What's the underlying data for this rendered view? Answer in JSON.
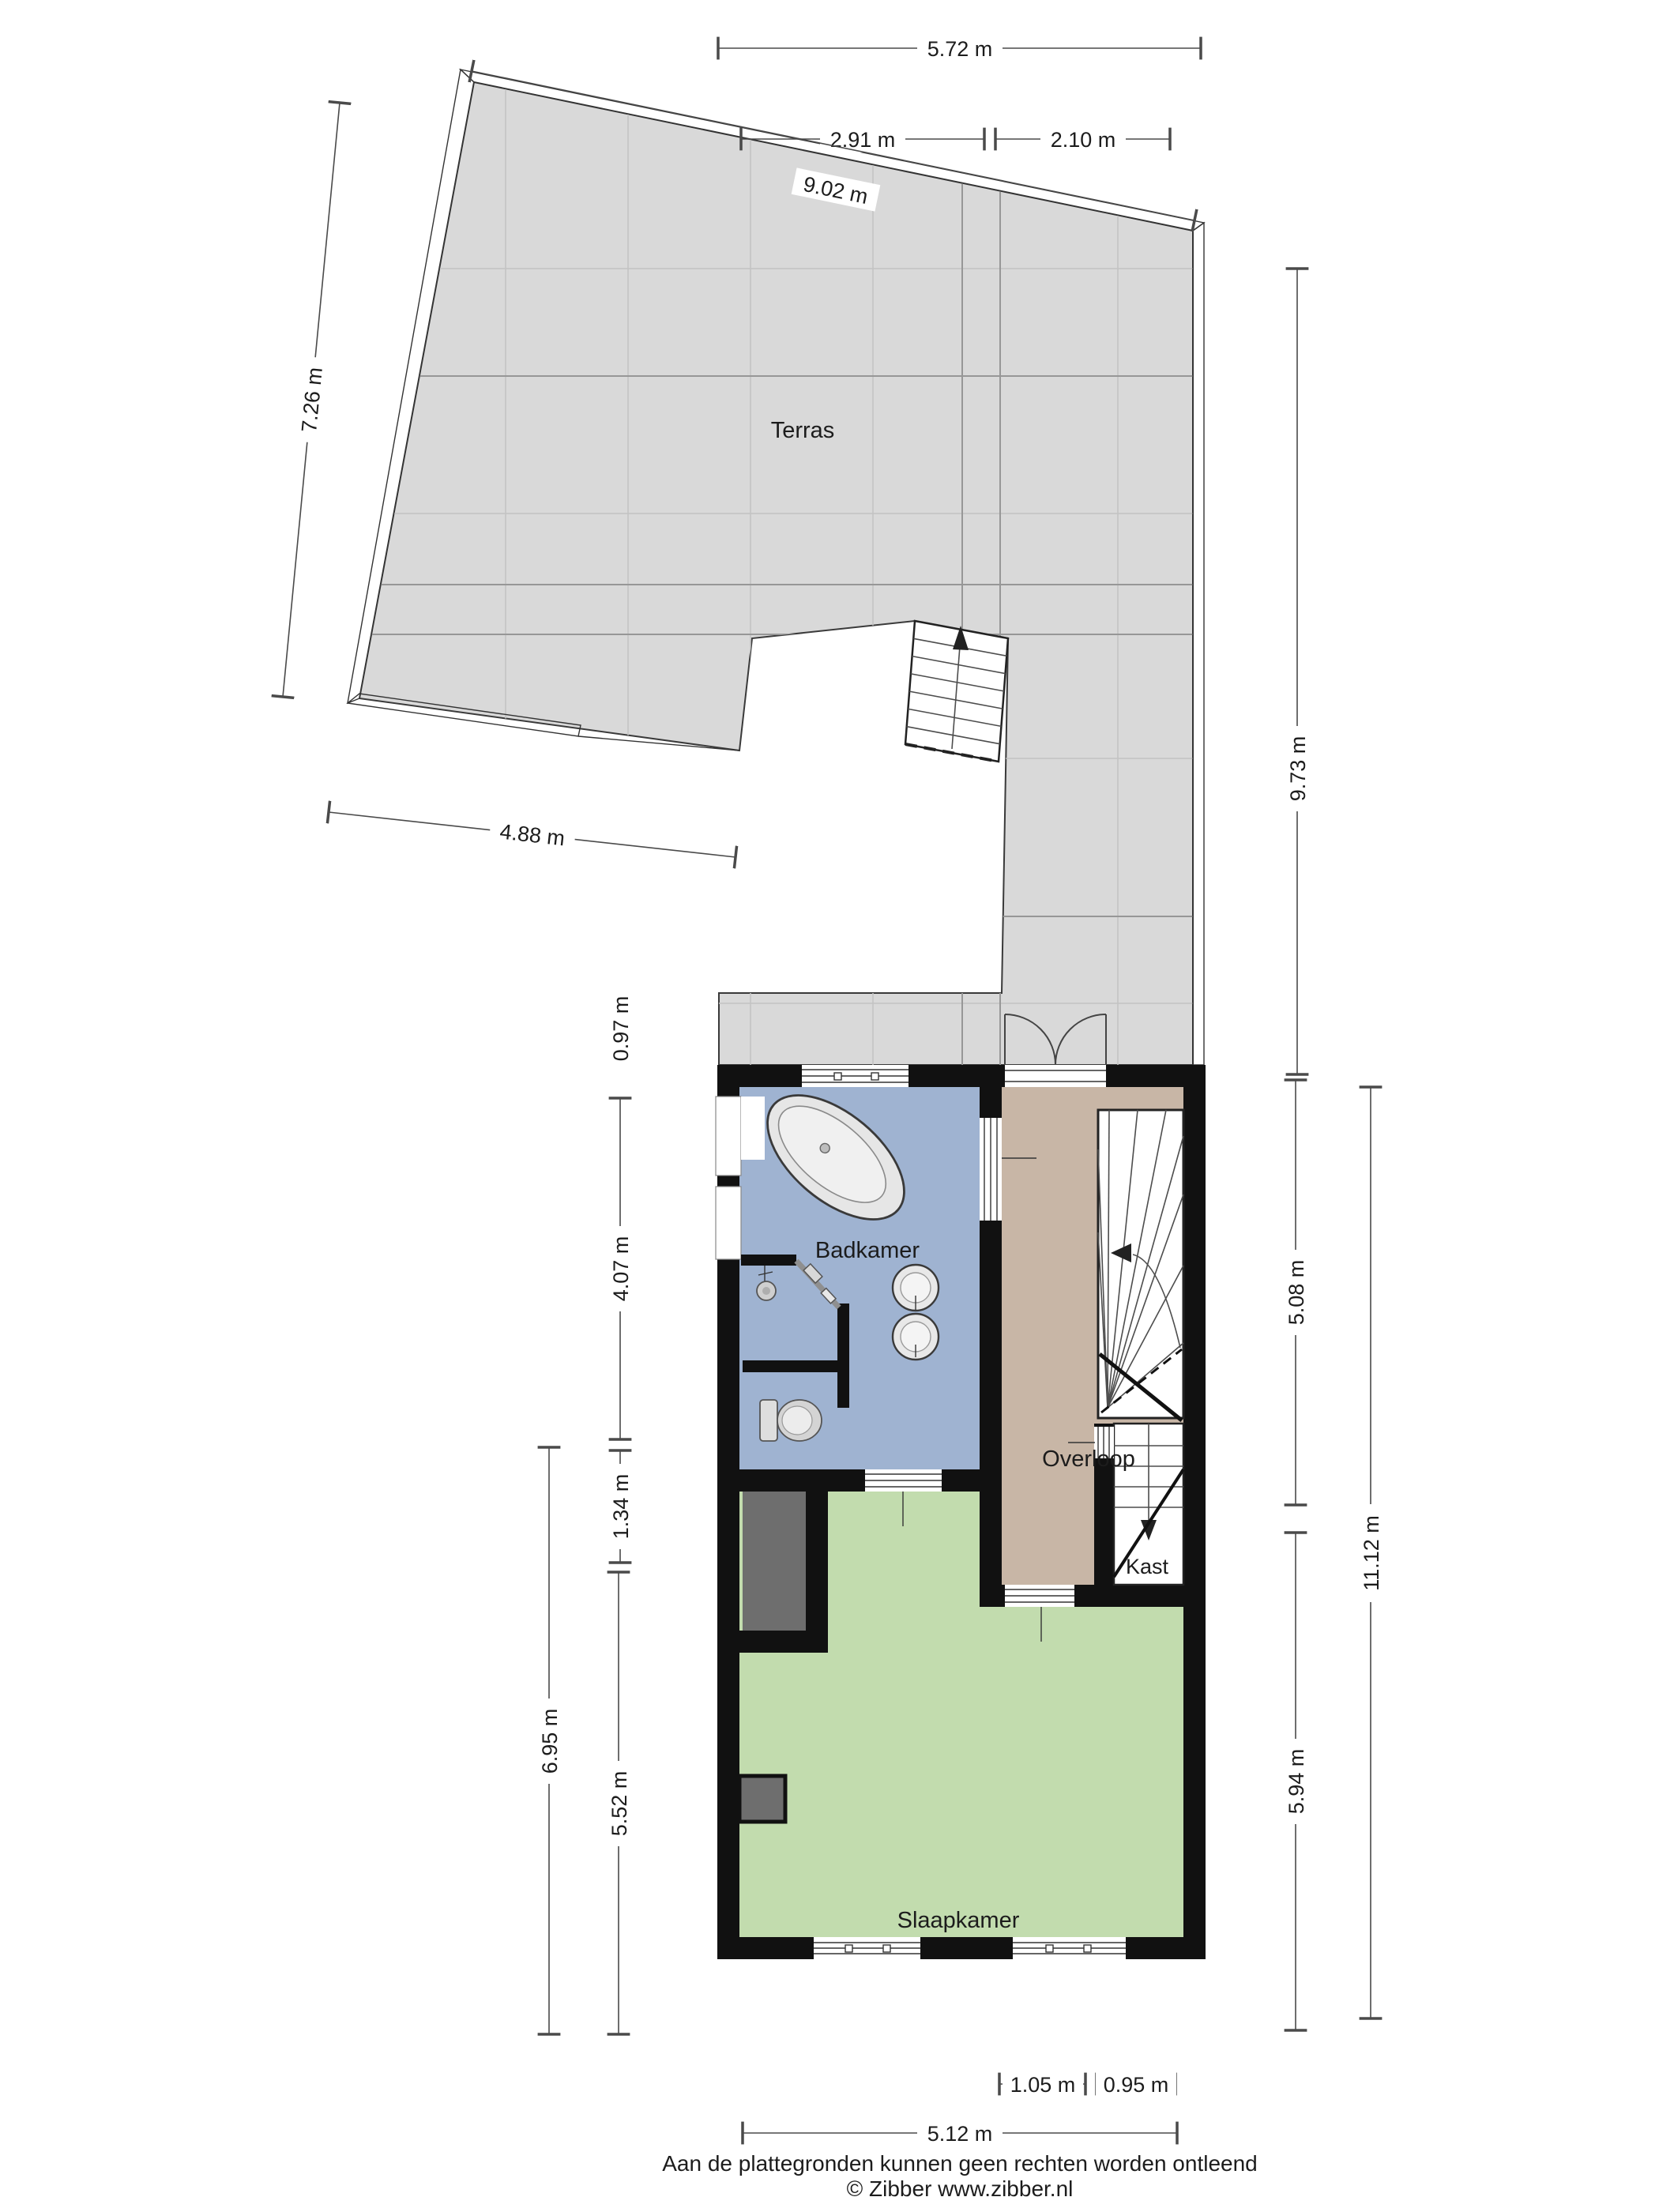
{
  "rooms": {
    "terrace": "Terras",
    "bathroom": "Badkamer",
    "landing": "Overloop",
    "closet": "Kast",
    "bedroom": "Slaapkamer"
  },
  "dimensions": {
    "top_total": "5.72 m",
    "top_left": "2.91 m",
    "top_right": "2.10 m",
    "top_diag": "9.02 m",
    "left_diag": "7.26 m",
    "terrace_bottom": "4.88 m",
    "terrace_right": "9.73 m",
    "strip": "0.97 m",
    "bathroom_h": "4.07 m",
    "niche_h": "1.34 m",
    "bedroom_left": "5.52 m",
    "left_total": "6.95 m",
    "landing_h": "5.08 m",
    "bedroom_right": "5.94 m",
    "right_total": "11.12 m",
    "win_left": "1.05 m",
    "win_right": "0.95 m",
    "bottom_total": "5.12 m"
  },
  "footer": {
    "line1": "Aan de plattegronden kunnen geen rechten worden ontleend",
    "line2": "© Zibber www.zibber.nl"
  },
  "colors": {
    "wall": "#111111",
    "terrace_floor": "#d9d9d9",
    "bathroom": "#9fb3d1",
    "landing": "#c8b6a6",
    "bedroom": "#c2dcae",
    "niche": "#6e6e6e"
  }
}
